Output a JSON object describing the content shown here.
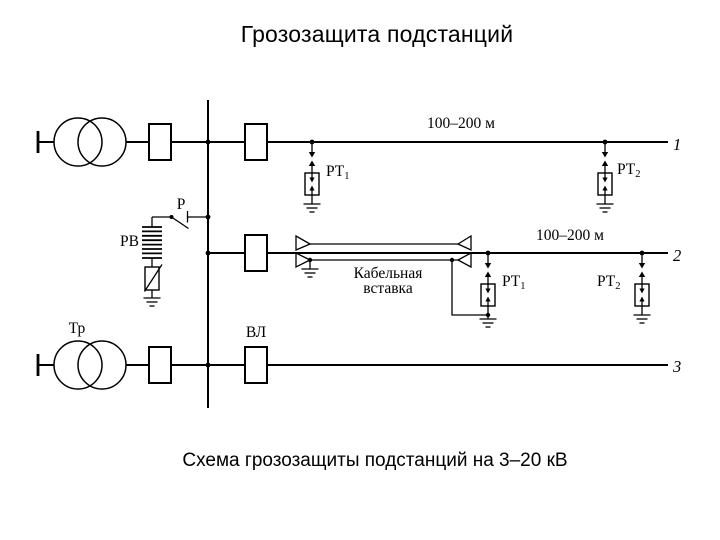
{
  "slide": {
    "title": "Грозозащита подстанций",
    "caption": "Схема грозозащиты подстанций на 3–20 кВ"
  },
  "diagram": {
    "colors": {
      "ink": "#000000",
      "background": "#ffffff"
    },
    "lines": {
      "line1": {
        "number": "1",
        "distance_label": "100–200 м"
      },
      "line2": {
        "number": "2",
        "distance_label": "100–200 м"
      },
      "line3": {
        "number": "3"
      }
    },
    "labels": {
      "transformer": "Тр",
      "overhead_line": "ВЛ",
      "valve_arrester": "РВ",
      "disconnector": "Р",
      "tubular_arrester_base": "РТ",
      "sub_1": "1",
      "sub_2": "2",
      "cable_insert_word1": "Кабельная",
      "cable_insert_word2": "вставка"
    }
  }
}
